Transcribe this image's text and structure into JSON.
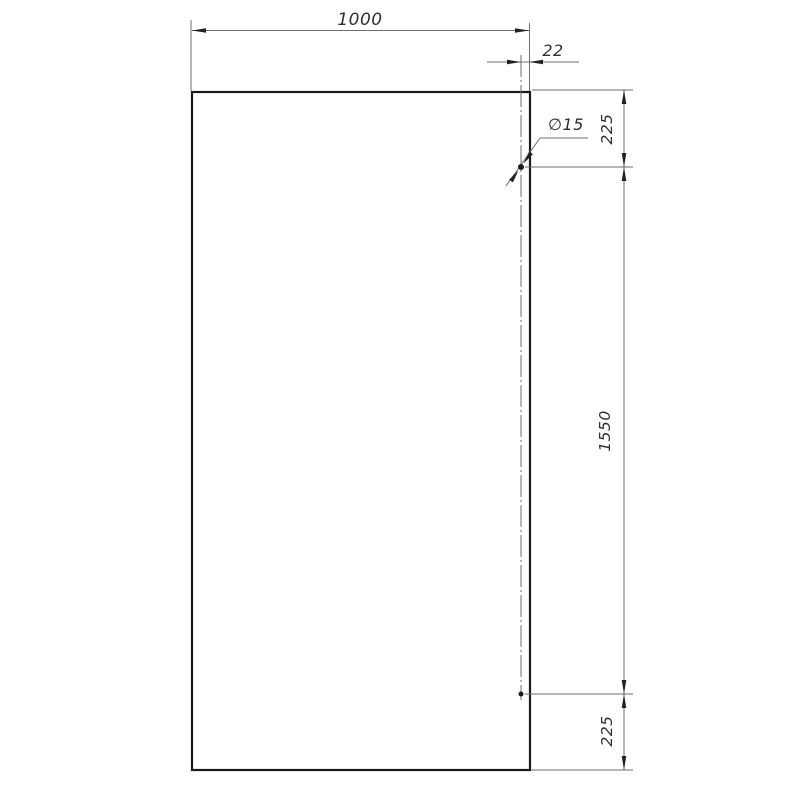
{
  "drawing_title": "panel-dimension-drawing",
  "colors": {
    "background": "#ffffff",
    "outline": "#1a1a1a",
    "thin_line": "#6e6e6e",
    "arrow": "#222222",
    "text": "#2f2f2f"
  },
  "dimensions": {
    "width": "1000",
    "hole_to_edge": "22",
    "hole_diameter": "∅15",
    "top_offset": "225",
    "hole_spacing": "1550",
    "bottom_offset": "225"
  }
}
